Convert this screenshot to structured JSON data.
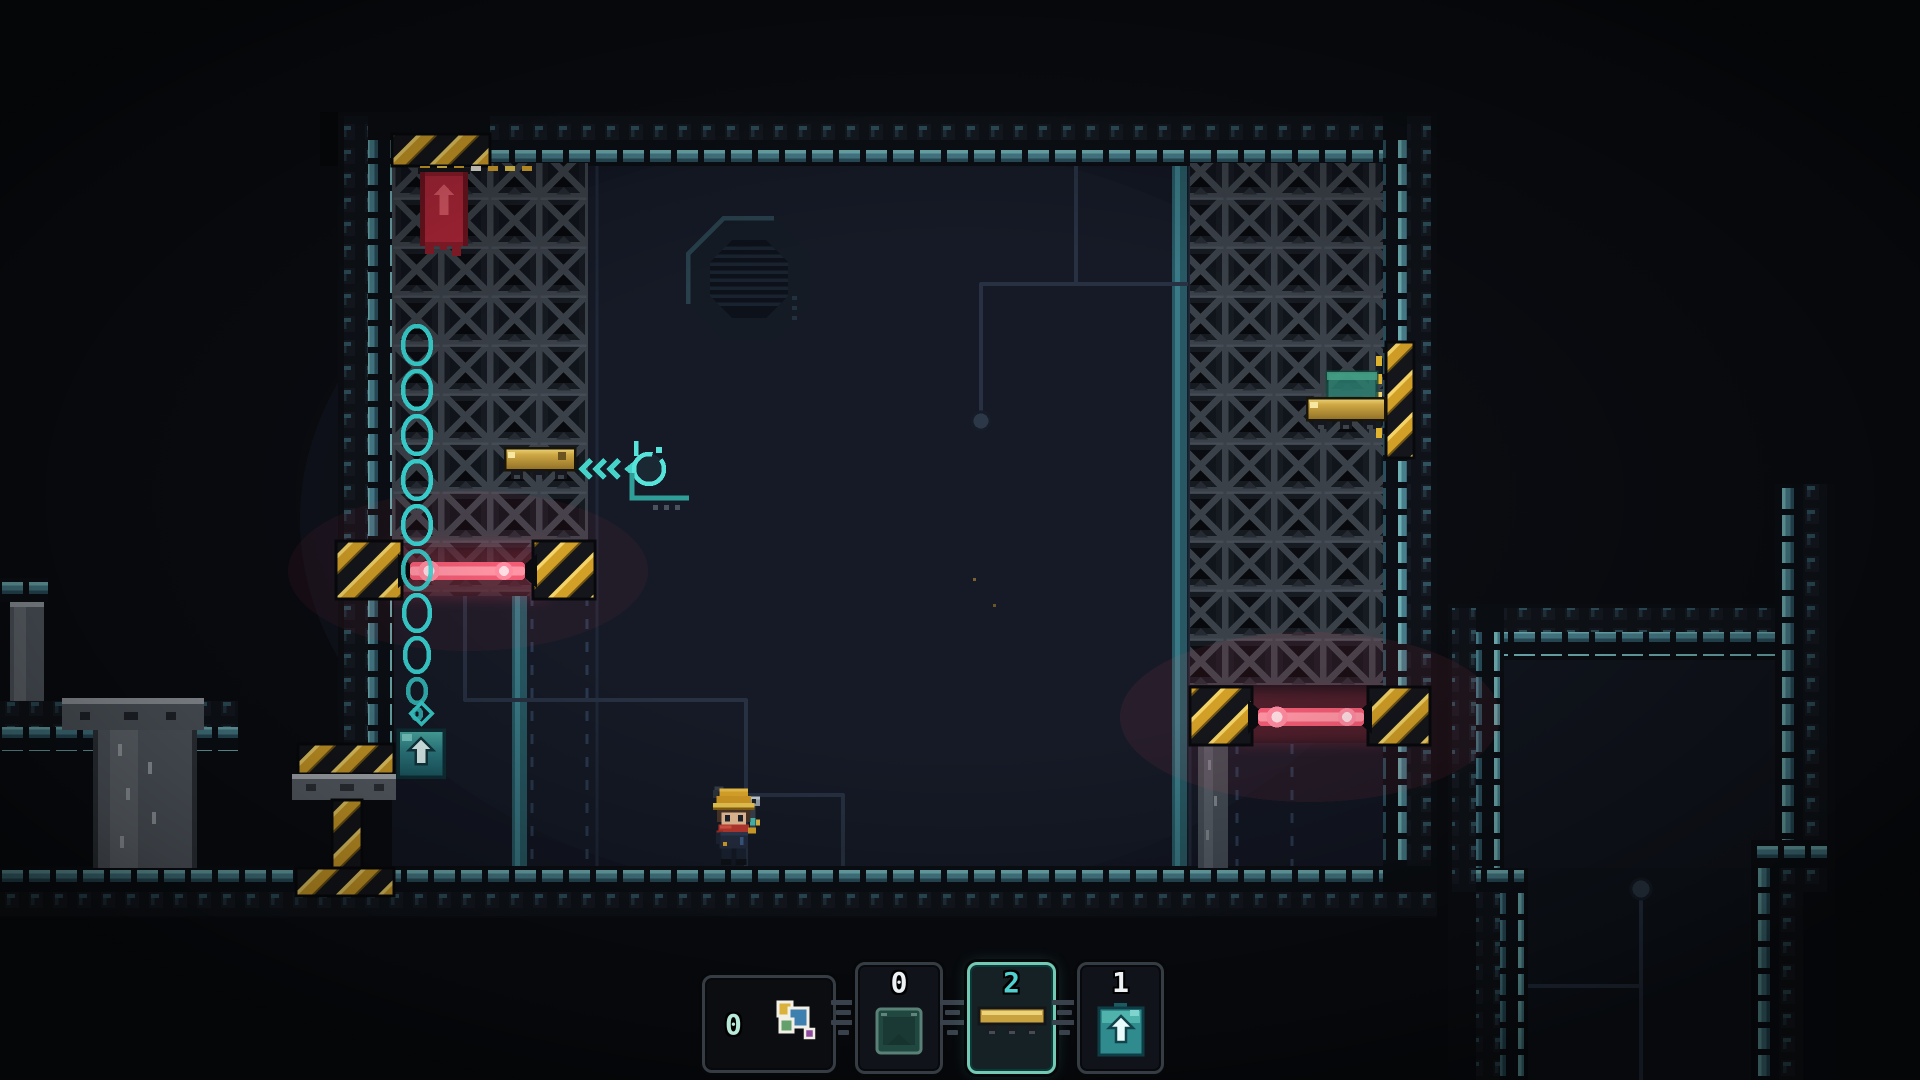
{
  "app": {
    "view": "pixel-platformer-level"
  },
  "hud": {
    "hotbar": {
      "selected_index": 2,
      "slots": [
        {
          "name": "block-palette",
          "count": "0",
          "icon": "color-blocks-icon",
          "selected": false
        },
        {
          "name": "green-crate-item",
          "count": "0",
          "icon": "green-crate-icon",
          "selected": false
        },
        {
          "name": "gold-platform-item",
          "count": "2",
          "icon": "gold-platform-icon",
          "selected": true
        },
        {
          "name": "jump-pad-item",
          "count": "1",
          "icon": "jump-pad-icon",
          "selected": false
        }
      ]
    }
  },
  "scene": {
    "character": "miner-with-wrench",
    "objects": [
      "crate-wall-left",
      "crate-wall-right",
      "laser-barrier-left",
      "laser-barrier-right",
      "bubble-column",
      "teal-jump-pad",
      "red-arrow-block",
      "floating-gold-platform",
      "wall-gold-platform",
      "green-crate-on-platform",
      "octagon-vent-hatch",
      "piston-press",
      "grabber-cursor",
      "wire-network",
      "right-room"
    ],
    "colors": {
      "background": "#0a0c10",
      "room": "#141723",
      "wall_accent": "#4a8390",
      "crate_frame": "#3b4149",
      "hazard_yellow": "#d8a62a",
      "laser_pink": "#ff5f7c",
      "teal_accent": "#45d2c9",
      "gold": "#cfa845",
      "red_block": "#b02739"
    }
  }
}
